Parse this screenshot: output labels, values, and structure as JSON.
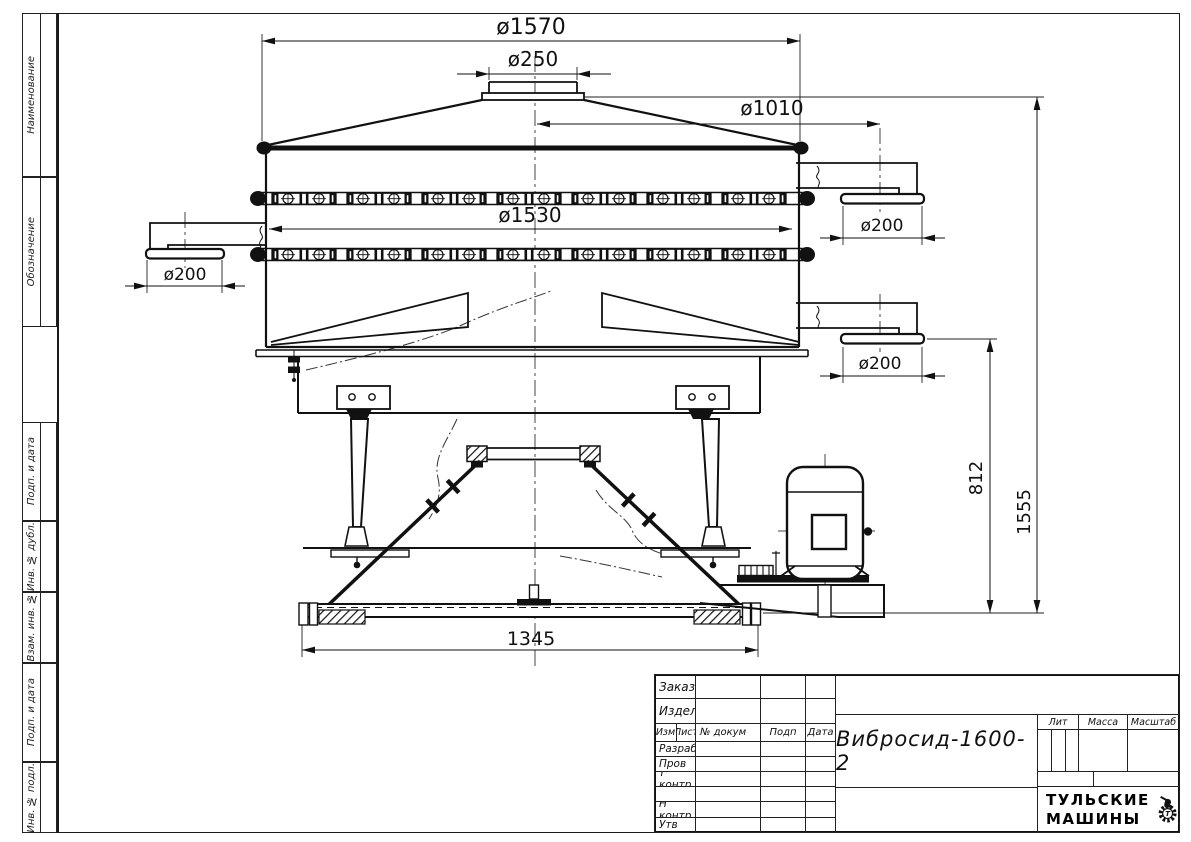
{
  "dims": {
    "top_diameter": "ø1570",
    "inlet_diameter": "ø250",
    "outlet_circle_diameter": "ø1010",
    "body_diameter": "ø1530",
    "left_outlet_diameter": "ø200",
    "right_upper_outlet_diameter": "ø200",
    "right_lower_outlet_diameter": "ø200",
    "outlet_height": "812",
    "total_height": "1555",
    "base_width": "1345"
  },
  "margins": {
    "top": [
      "Наименование",
      "Обозначение"
    ],
    "bottom": [
      "Подп. и дата",
      "Инв. № дубл.",
      "Взам. инв. №",
      "Подп. и дата",
      "Инв. № подл."
    ]
  },
  "title_block": {
    "order_label": "Заказ",
    "product_label": "Изделие",
    "col_izm": "Изм",
    "col_list": "Лист",
    "col_doc": "№ докум",
    "col_sign": "Подп",
    "col_date": "Дата",
    "row_developed": "Разраб",
    "row_checked": "Пров",
    "row_tcontrol": "Т контр",
    "row_ncontrol": "Н контр",
    "row_approved": "Утв",
    "doc_title": "Вибросид-1600-2",
    "lit_label": "Лит",
    "mass_label": "Масса",
    "scale_label": "Масштаб",
    "brand_line1": "ТУЛЬСКИЕ",
    "brand_line2": "МАШИНЫ",
    "brand_gear_letter": "Т"
  }
}
